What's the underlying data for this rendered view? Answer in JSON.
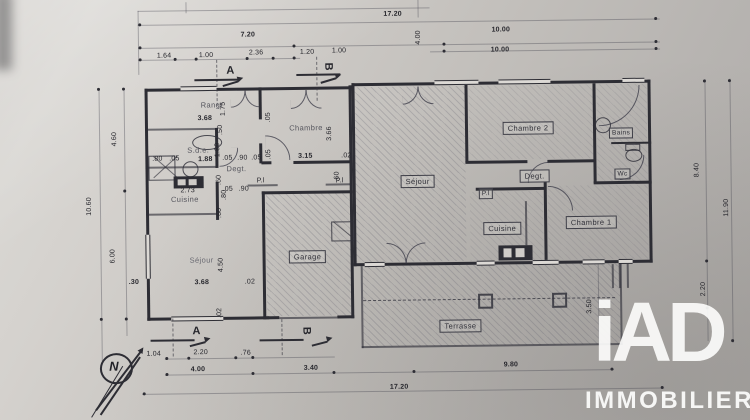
{
  "dims": {
    "top_total": "17.20",
    "top_left": "7.20",
    "top_gap_v": "4.00",
    "top_right_a": "10.00",
    "top_right_b": "10.00",
    "seg_164": "1.64",
    "seg_100a": "1.00",
    "seg_236": "2.36",
    "seg_120": "1.20",
    "seg_100b": "1.00",
    "left_upper": "4.60",
    "left_total": "10.60",
    "left_lower": "6.00",
    "left_offset": ".30",
    "right_upper": "8.40",
    "right_total": "11.90",
    "right_lower": "2.20",
    "bot_104": "1.04",
    "bot_220": "2.20",
    "bot_76": ".76",
    "bot_400": "4.00",
    "bot_340": "3.40",
    "bot_terrace": "9.80",
    "bot_total": "17.20",
    "terrace_depth": "3.50"
  },
  "left_wing": {
    "rangt": "Rangt",
    "rangt_w": "3.68",
    "rangt_h": "1.75",
    "chambre": "Chambre",
    "chambre_w": "3.15",
    "chambre_h": "3.66",
    "chambre_eps": ".02",
    "sde": "S.d.e.",
    "sde_w": "1.88",
    "sde_a": ".80",
    "sde_b": ".05",
    "degt": "Degt.",
    "t1": ".05",
    "t2": ".90",
    "t3": ".05",
    "t4": ".05",
    "t5": ".90",
    "cuisine": "Cuisine",
    "counter_w": "2.73",
    "sejour": "Séjour",
    "sejour_w": "3.68",
    "sejour_h": "4.50",
    "sejour_eps": ".02",
    "pl_a": "P.l",
    "pl_b": "P.l",
    "v_050": ".50",
    "v_180": "1.80",
    "v_060a": ".60",
    "v_080": ".80",
    "v_060b": ".60",
    "v_060c": ".60",
    "v_005a": ".05",
    "v_005b": ".05",
    "v_002": ".02"
  },
  "right_wing": {
    "sejour": "Séjour",
    "chambre2": "Chambre 2",
    "bains": "Bains",
    "wc": "Wc",
    "degt": "Degt.",
    "pl": "P.l",
    "cuisine": "Cuisine",
    "chambre1": "Chambre 1",
    "terrasse": "Terrasse"
  },
  "garage": {
    "label": "Garage"
  },
  "markers": {
    "a": "A",
    "b": "B"
  },
  "compass": {
    "north": "N"
  },
  "logo": {
    "brand": "iAD",
    "subtitle": "IMMOBILIER"
  }
}
